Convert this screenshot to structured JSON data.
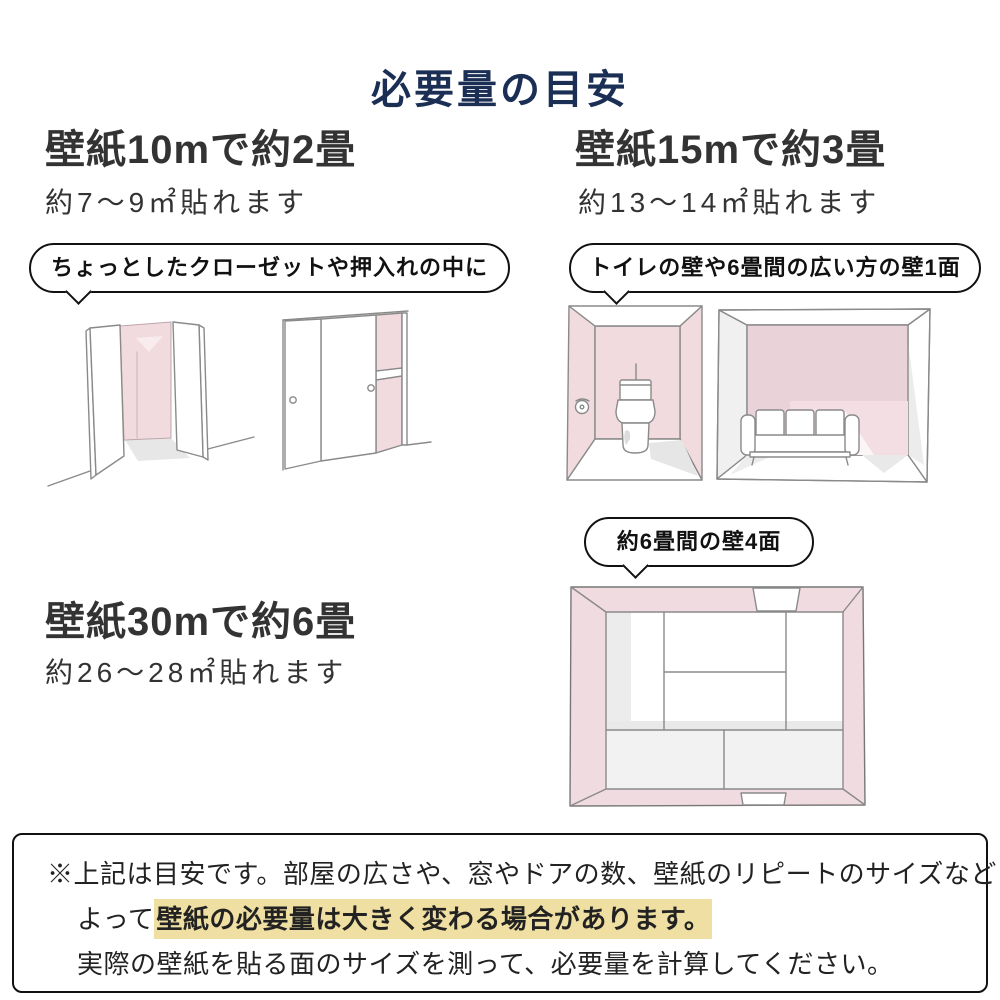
{
  "title": "必要量の目安",
  "sections": {
    "wall10": {
      "heading": "壁紙10mで約2畳",
      "subheading": "約7〜9㎡貼れます",
      "bubble": "ちょっとしたクローゼットや押入れの中に",
      "illustration_icons": [
        "open-closet-illustration",
        "sliding-door-closet-illustration"
      ]
    },
    "wall15": {
      "heading": "壁紙15mで約3畳",
      "subheading": "約13〜14㎡貼れます",
      "bubble": "トイレの壁や6畳間の広い方の壁1面",
      "illustration_icons": [
        "toilet-room-illustration",
        "living-room-sofa-illustration"
      ]
    },
    "wall30": {
      "heading": "壁紙30mで約6畳",
      "subheading": "約26〜28㎡貼れます",
      "bubble": "約6畳間の壁4面",
      "illustration_icons": [
        "six-tatami-room-top-view-illustration"
      ]
    }
  },
  "note": {
    "line1": "※上記は目安です。部屋の広さや、窓やドアの数、壁紙のリピートのサイズなどに",
    "line2_prefix": "よって",
    "line2_highlight": "壁紙の必要量は大きく変わる場合があります。",
    "line3": "実際の壁紙を貼る面のサイズを測って、必要量を計算してください。"
  },
  "colors": {
    "title_navy": "#1b2f55",
    "heading_gray": "#333333",
    "wall_pink": "#f1dbdf",
    "wall_pink_dark": "#e9d2d8",
    "sketch_line": "#8a8a8a",
    "highlight_yellow": "#efdfa2",
    "bubble_border": "#111111"
  }
}
